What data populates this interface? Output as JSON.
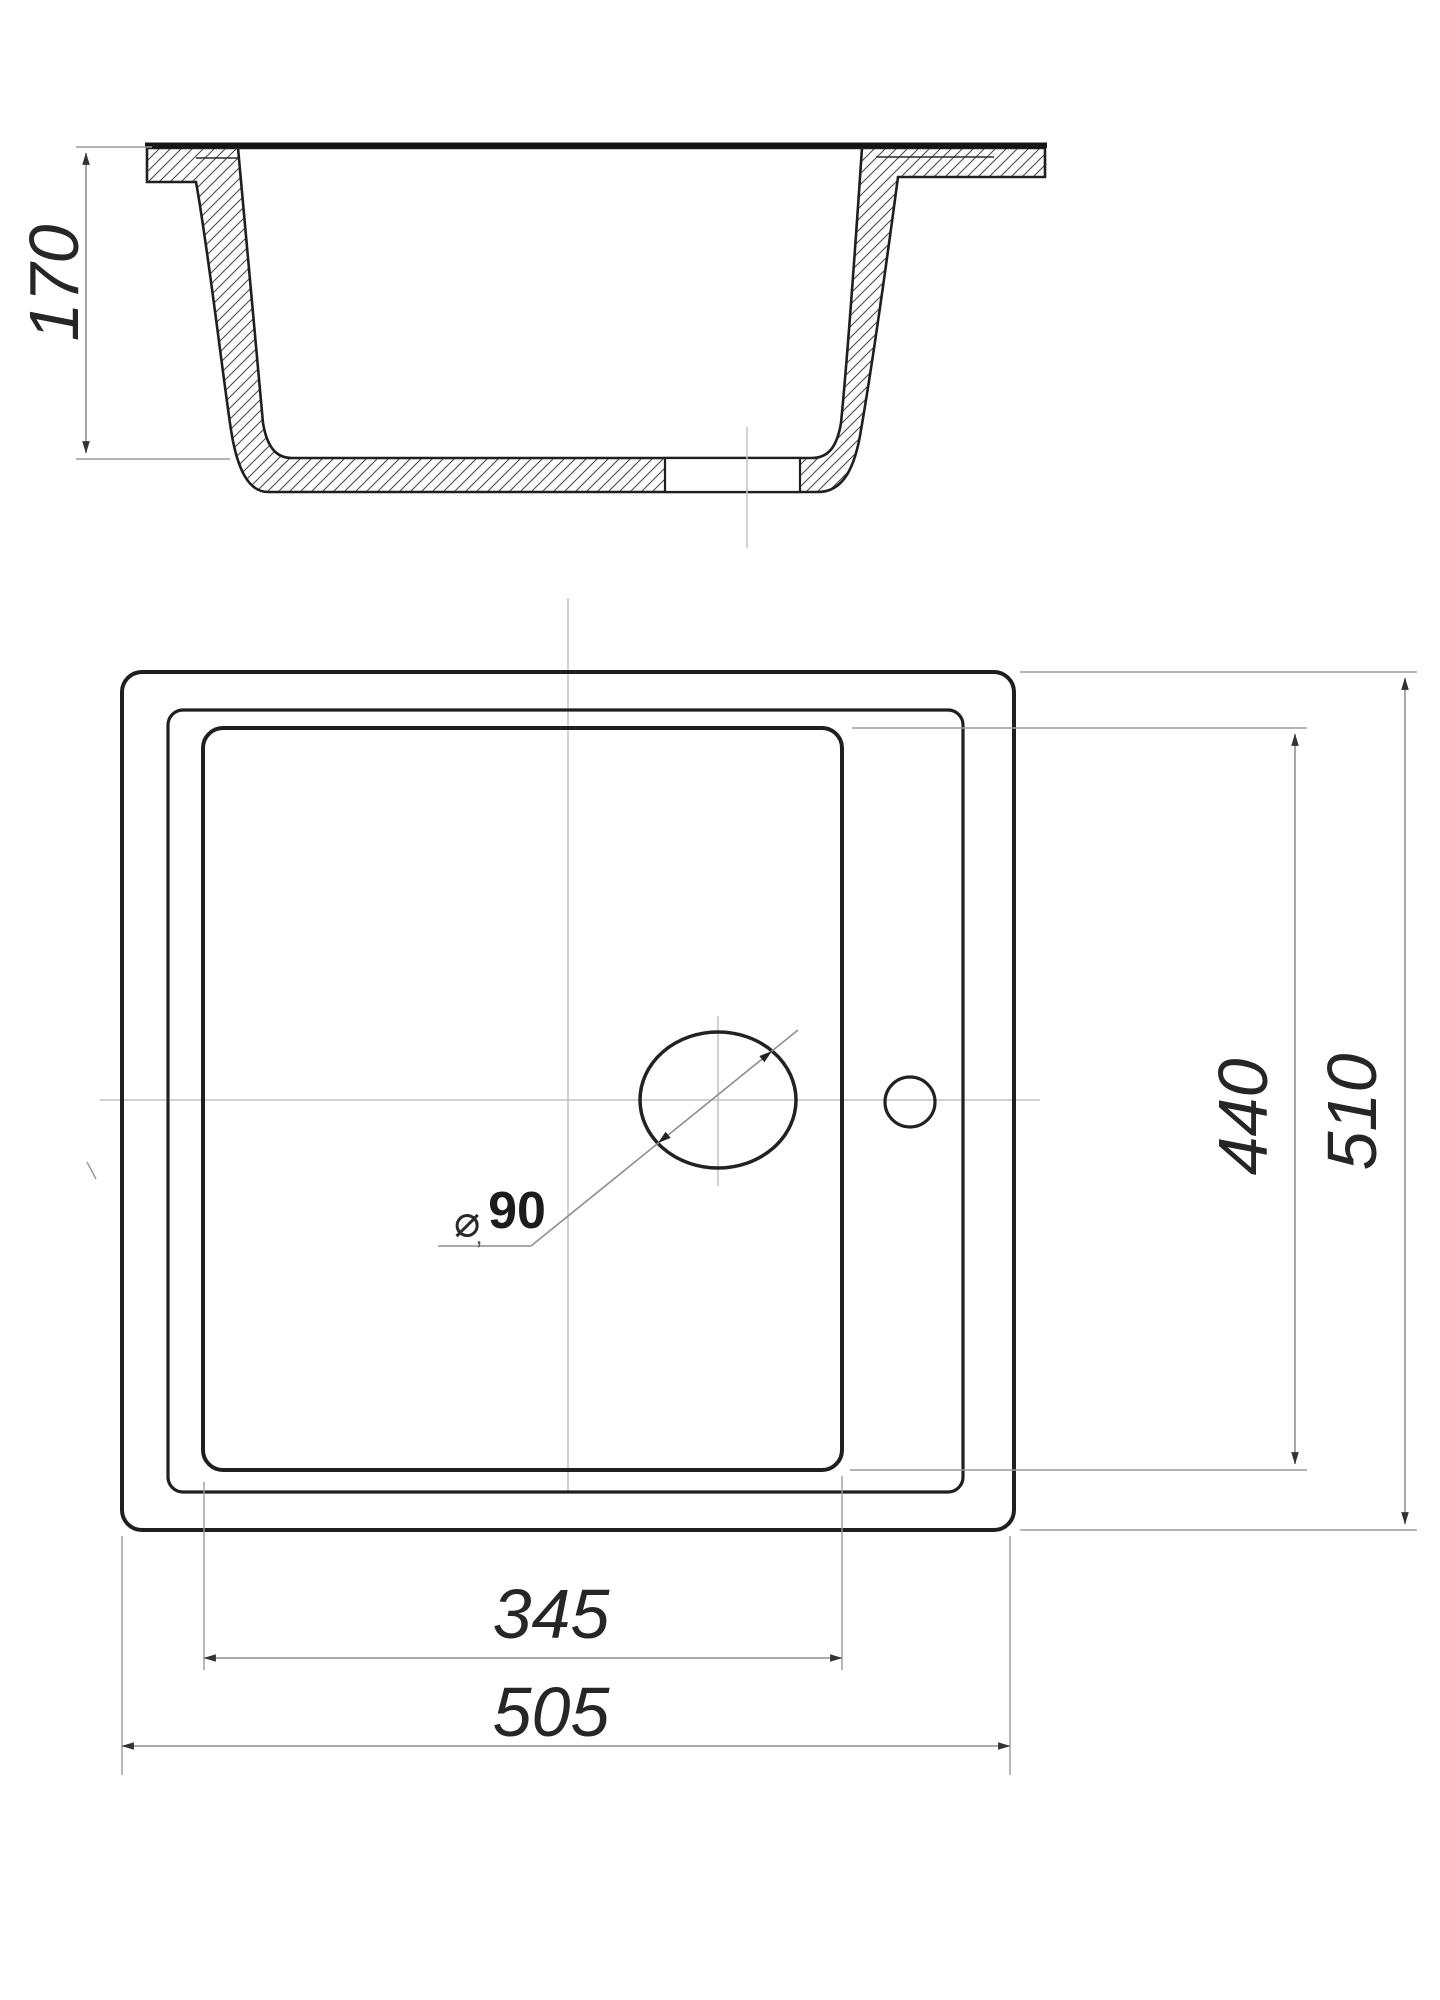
{
  "page": {
    "background": "#ffffff"
  },
  "colors": {
    "drawing_line": "#1f1f1f",
    "dimension_line": "#8f8f8f",
    "centerline": "#c2c2c2",
    "hatch": "#4a4a4a",
    "text": "#262626"
  },
  "section_view": {
    "description": "cross-section of sink bowl with hatched walls",
    "depth_dimension": {
      "value": "170"
    }
  },
  "plan_view": {
    "description": "top view of sink with bowl, drain hole and faucet hole",
    "bowl_width_dimension": {
      "value": "345"
    },
    "overall_width_dimension": {
      "value": "505"
    },
    "bowl_length_dimension": {
      "value": "440"
    },
    "overall_length_dimension": {
      "value": "510"
    },
    "drain_dimension": {
      "symbol": "⌀",
      "value": "90",
      "stray_mark": ","
    }
  }
}
